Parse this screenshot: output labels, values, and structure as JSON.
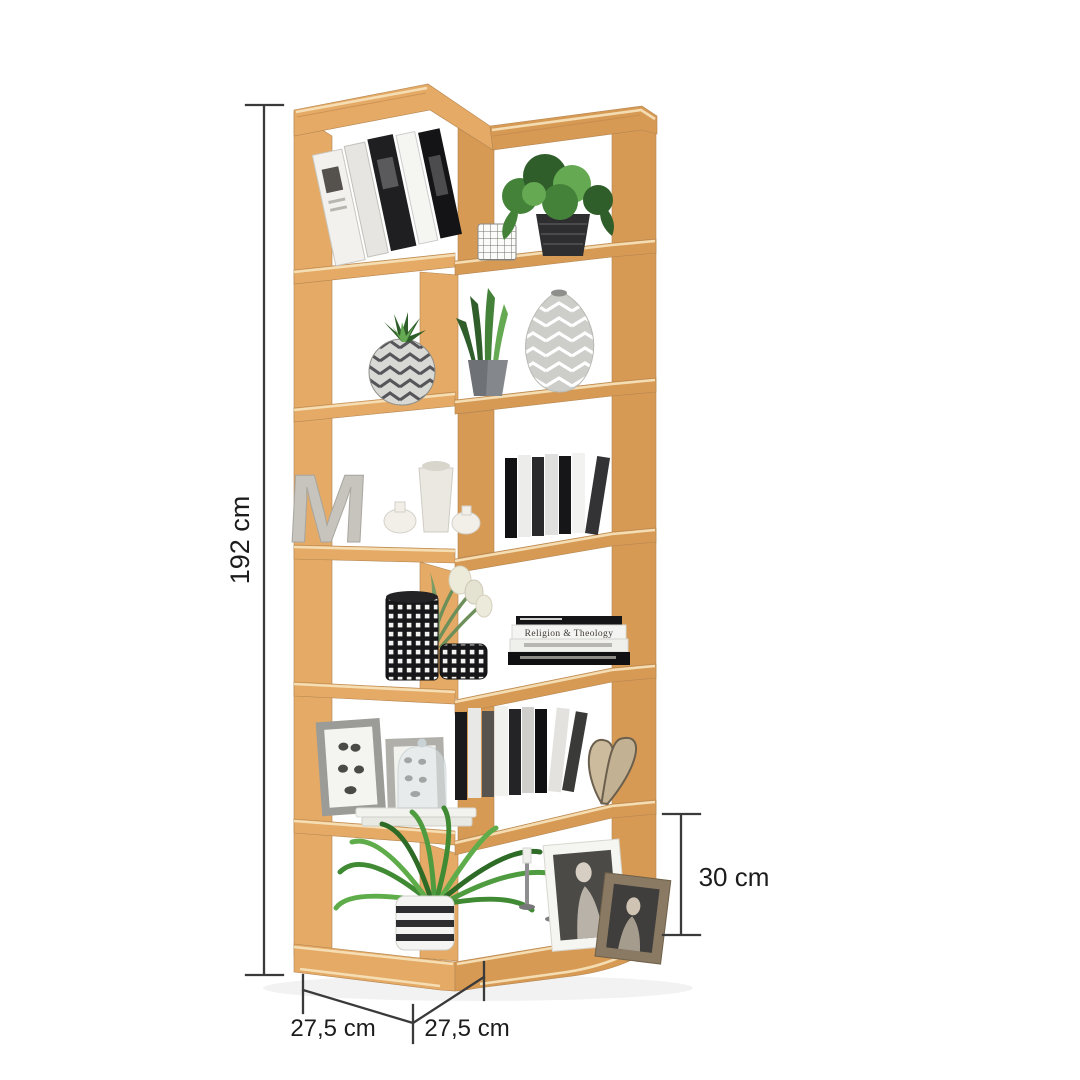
{
  "image": {
    "type": "product-render",
    "subject": "corner zig-zag bookshelf with six levels and decorative items",
    "background": "#ffffff"
  },
  "dimensions": {
    "height": "192 cm",
    "shelf_height": "30 cm",
    "depth_left": "27,5 cm",
    "depth_right": "27,5 cm"
  },
  "colors": {
    "bg": "#ffffff",
    "wood_light": "#e4aa66",
    "wood_mid": "#d69a55",
    "wood_top": "#f2cd9d",
    "wood_dark": "#c08448",
    "wood_edge": "#f6e0b8",
    "dim_line": "#3a3a3a",
    "label_text": "#1c1c1c",
    "plant_dark": "#2f5e2a",
    "plant_mid": "#44823a",
    "plant_light": "#65a952"
  },
  "shelves": [
    {
      "level": 1,
      "items": [
        "leaning books",
        "potted plant in black pot",
        "wire basket"
      ]
    },
    {
      "level": 2,
      "items": [
        "succulent in chevron ball vase",
        "snake plant in grey pot",
        "chevron teardrop vase"
      ]
    },
    {
      "level": 3,
      "items": [
        "concrete letter decor",
        "white ceramic vases",
        "row of standing books"
      ],
      "letter_text": "M"
    },
    {
      "level": 4,
      "items": [
        "chequered vase with white tulips",
        "chequered bowl",
        "stack of books"
      ],
      "book_spine_text": "Religion & Theology"
    },
    {
      "level": 5,
      "items": [
        "framed butterfly prints",
        "glass cloche on books",
        "row of standing books",
        "butterfly cut-out"
      ]
    },
    {
      "level": 6,
      "items": [
        "spider plant in striped pot",
        "candlesticks",
        "two framed portrait photos"
      ]
    }
  ]
}
